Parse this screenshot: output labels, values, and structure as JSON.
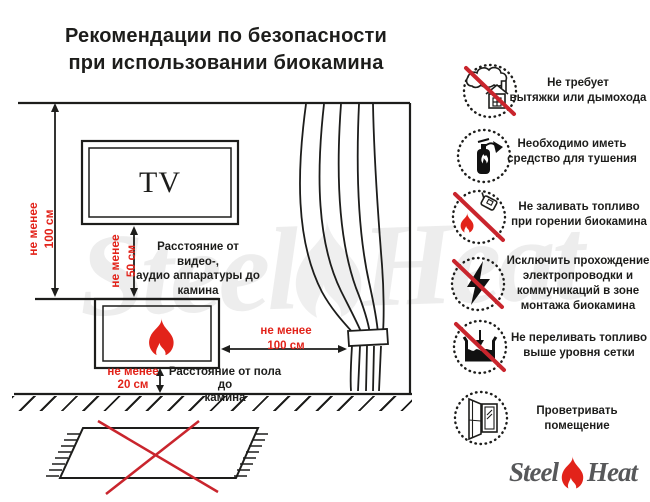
{
  "title": "Рекомендации по безопасности\nпри использовании биокамина",
  "colors": {
    "accent_red": "#e2231a",
    "prohibition_red": "#c9252d",
    "line_black": "#1d1d1b",
    "logo_gray": "#57585a"
  },
  "diagram": {
    "tv_label": "TV",
    "dim_wall": "не менее\n100 см",
    "dim_tv": "не менее\n50 см",
    "tv_note": "Расстояние от видео-,\nаудио аппаратуры до\nкамина",
    "dim_curtain": "не менее\n100 см",
    "dim_floor": "не менее\n20 см",
    "floor_note": "Расстояние от пола до\nкамина"
  },
  "rules": [
    {
      "icon": "no-chimney-icon",
      "label": "Не требует\nвытяжки или дымохода"
    },
    {
      "icon": "extinguisher-icon",
      "label": "Необходимо иметь\nсредство для тушения"
    },
    {
      "icon": "no-refuel-while-burning-icon",
      "label": "Не заливать топливо\nпри горении биокамина"
    },
    {
      "icon": "no-wiring-icon",
      "label": "Исключить прохождение\nэлектропроводки и\nкоммуникаций в зоне\nмонтажа биокамина"
    },
    {
      "icon": "no-overfill-icon",
      "label": "Не переливать топливо\nвыше уровня сетки"
    },
    {
      "icon": "ventilate-icon",
      "label": "Проветривать\nпомещение"
    }
  ],
  "brand": {
    "steel": "Steel",
    "heat": "Heat"
  },
  "watermark": {
    "steel": "Steel",
    "heat": "Heat"
  }
}
